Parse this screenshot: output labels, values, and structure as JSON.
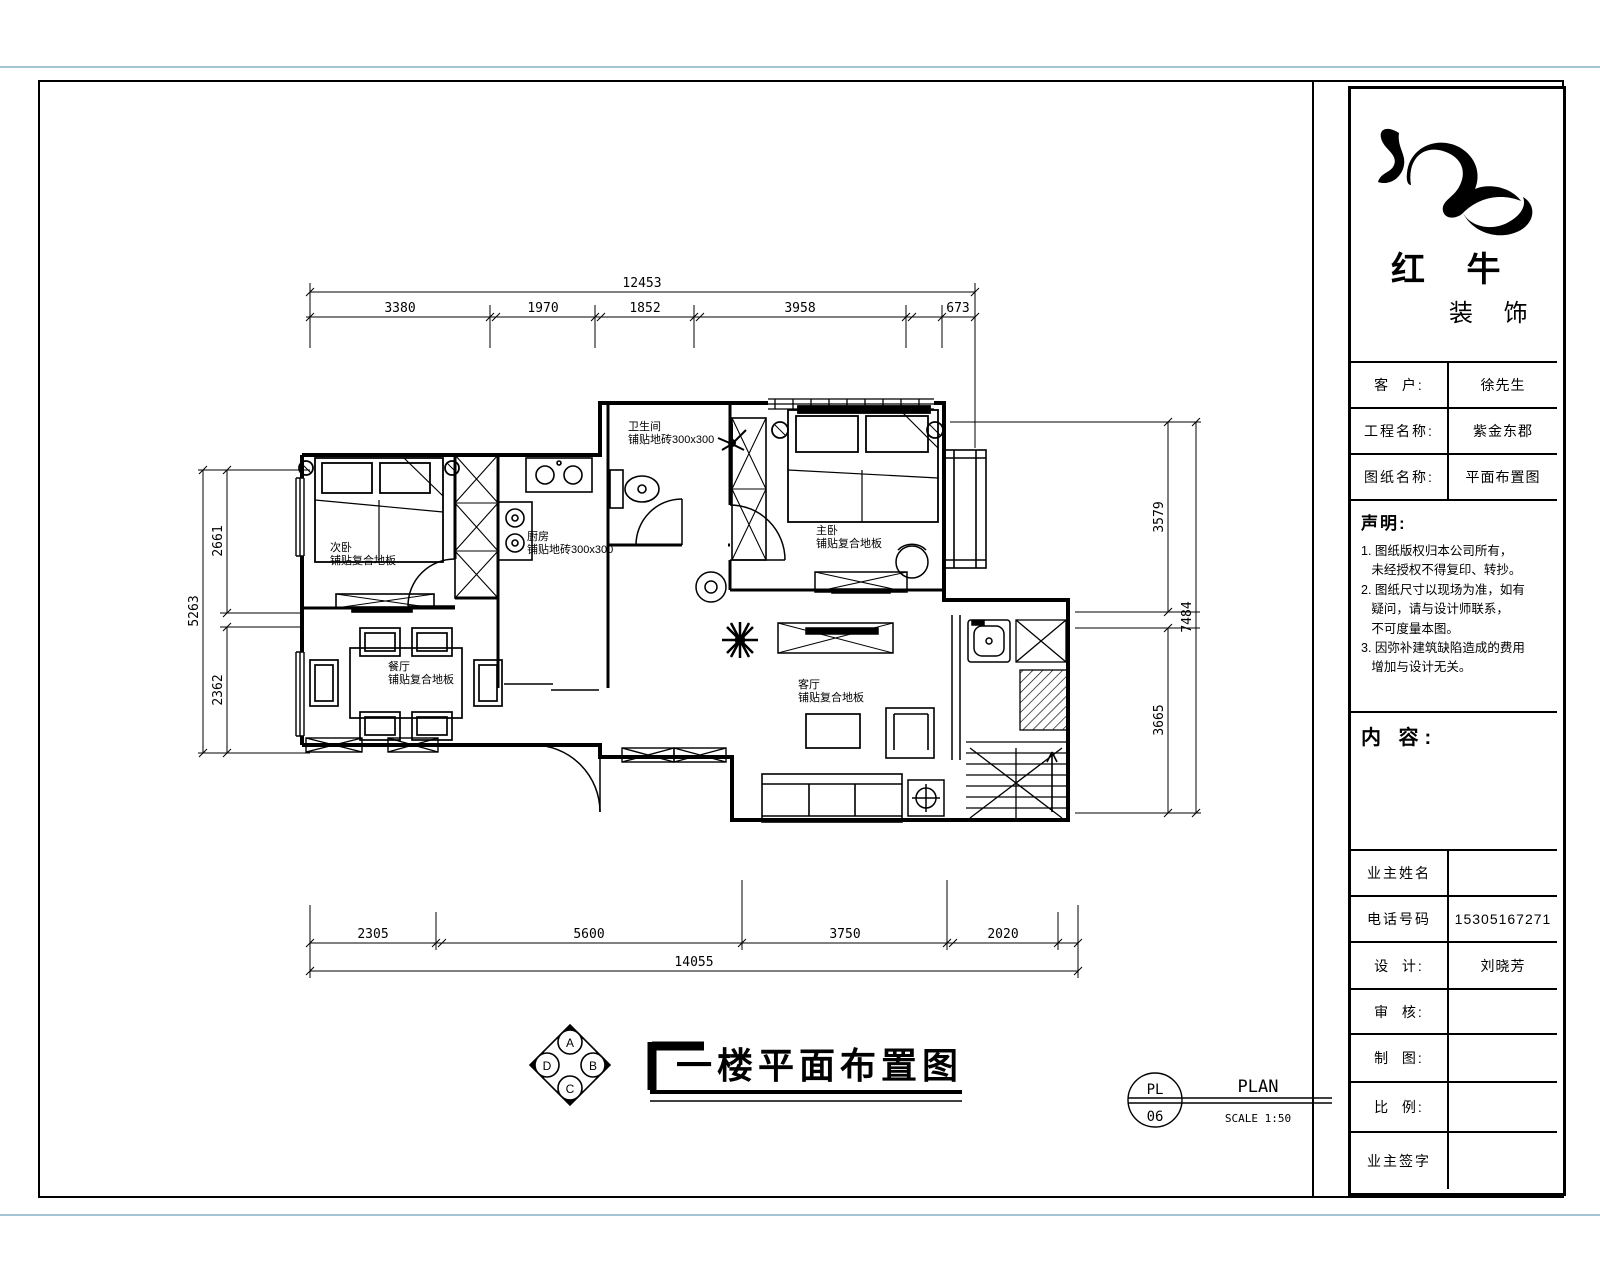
{
  "title_block": {
    "logo_line1": "红 牛",
    "logo_line2": "装 饰",
    "info_rows": [
      {
        "label": "客  户:",
        "value": "徐先生"
      },
      {
        "label": "工程名称:",
        "value": "紫金东郡"
      },
      {
        "label": "图纸名称:",
        "value": "平面布置图"
      }
    ],
    "statement_title": "声明:",
    "statement_lines": [
      "1. 图纸版权归本公司所有，",
      "   未经授权不得复印、转抄。",
      "2. 图纸尺寸以现场为准，如有",
      "   疑问，请与设计师联系，",
      "   不可度量本图。",
      "3. 因弥补建筑缺陷造成的费用",
      "   增加与设计无关。"
    ],
    "content_label": "内 容:",
    "sign_rows": [
      {
        "label": "业主姓名",
        "value": ""
      },
      {
        "label": "电话号码",
        "value": "15305167271"
      },
      {
        "label": "设  计:",
        "value": "刘晓芳"
      },
      {
        "label": "审  核:",
        "value": ""
      },
      {
        "label": "制  图:",
        "value": ""
      },
      {
        "label": "比  例:",
        "value": ""
      },
      {
        "label": "业主签字",
        "value": ""
      }
    ]
  },
  "drawing": {
    "title": "一楼平面布置图",
    "ref": {
      "code_top": "PL",
      "code_bottom": "06",
      "name": "PLAN",
      "scale": "SCALE 1:50"
    },
    "compass": {
      "top": "A",
      "right": "B",
      "bottom": "C",
      "left": "D"
    },
    "rooms": [
      {
        "name": "次卧",
        "finish": "铺贴复合地板"
      },
      {
        "name": "厨房",
        "finish": "铺贴地砖300x300"
      },
      {
        "name": "卫生间",
        "finish": "铺贴地砖300x300"
      },
      {
        "name": "主卧",
        "finish": "铺贴复合地板"
      },
      {
        "name": "餐厅",
        "finish": "铺贴复合地板"
      },
      {
        "name": "客厅",
        "finish": "铺贴复合地板"
      }
    ],
    "dims_top": {
      "overall": "12453",
      "segments": [
        "3380",
        "1970",
        "1852",
        "3958",
        "673"
      ]
    },
    "dims_bottom": {
      "overall": "14055",
      "segments": [
        "2305",
        "5600",
        "3750",
        "2020"
      ]
    },
    "dims_left": {
      "overall": "5263",
      "segments": [
        "2661",
        "2362"
      ]
    },
    "dims_right": {
      "overall": "7484",
      "segments": [
        "3579",
        "3665"
      ]
    }
  }
}
